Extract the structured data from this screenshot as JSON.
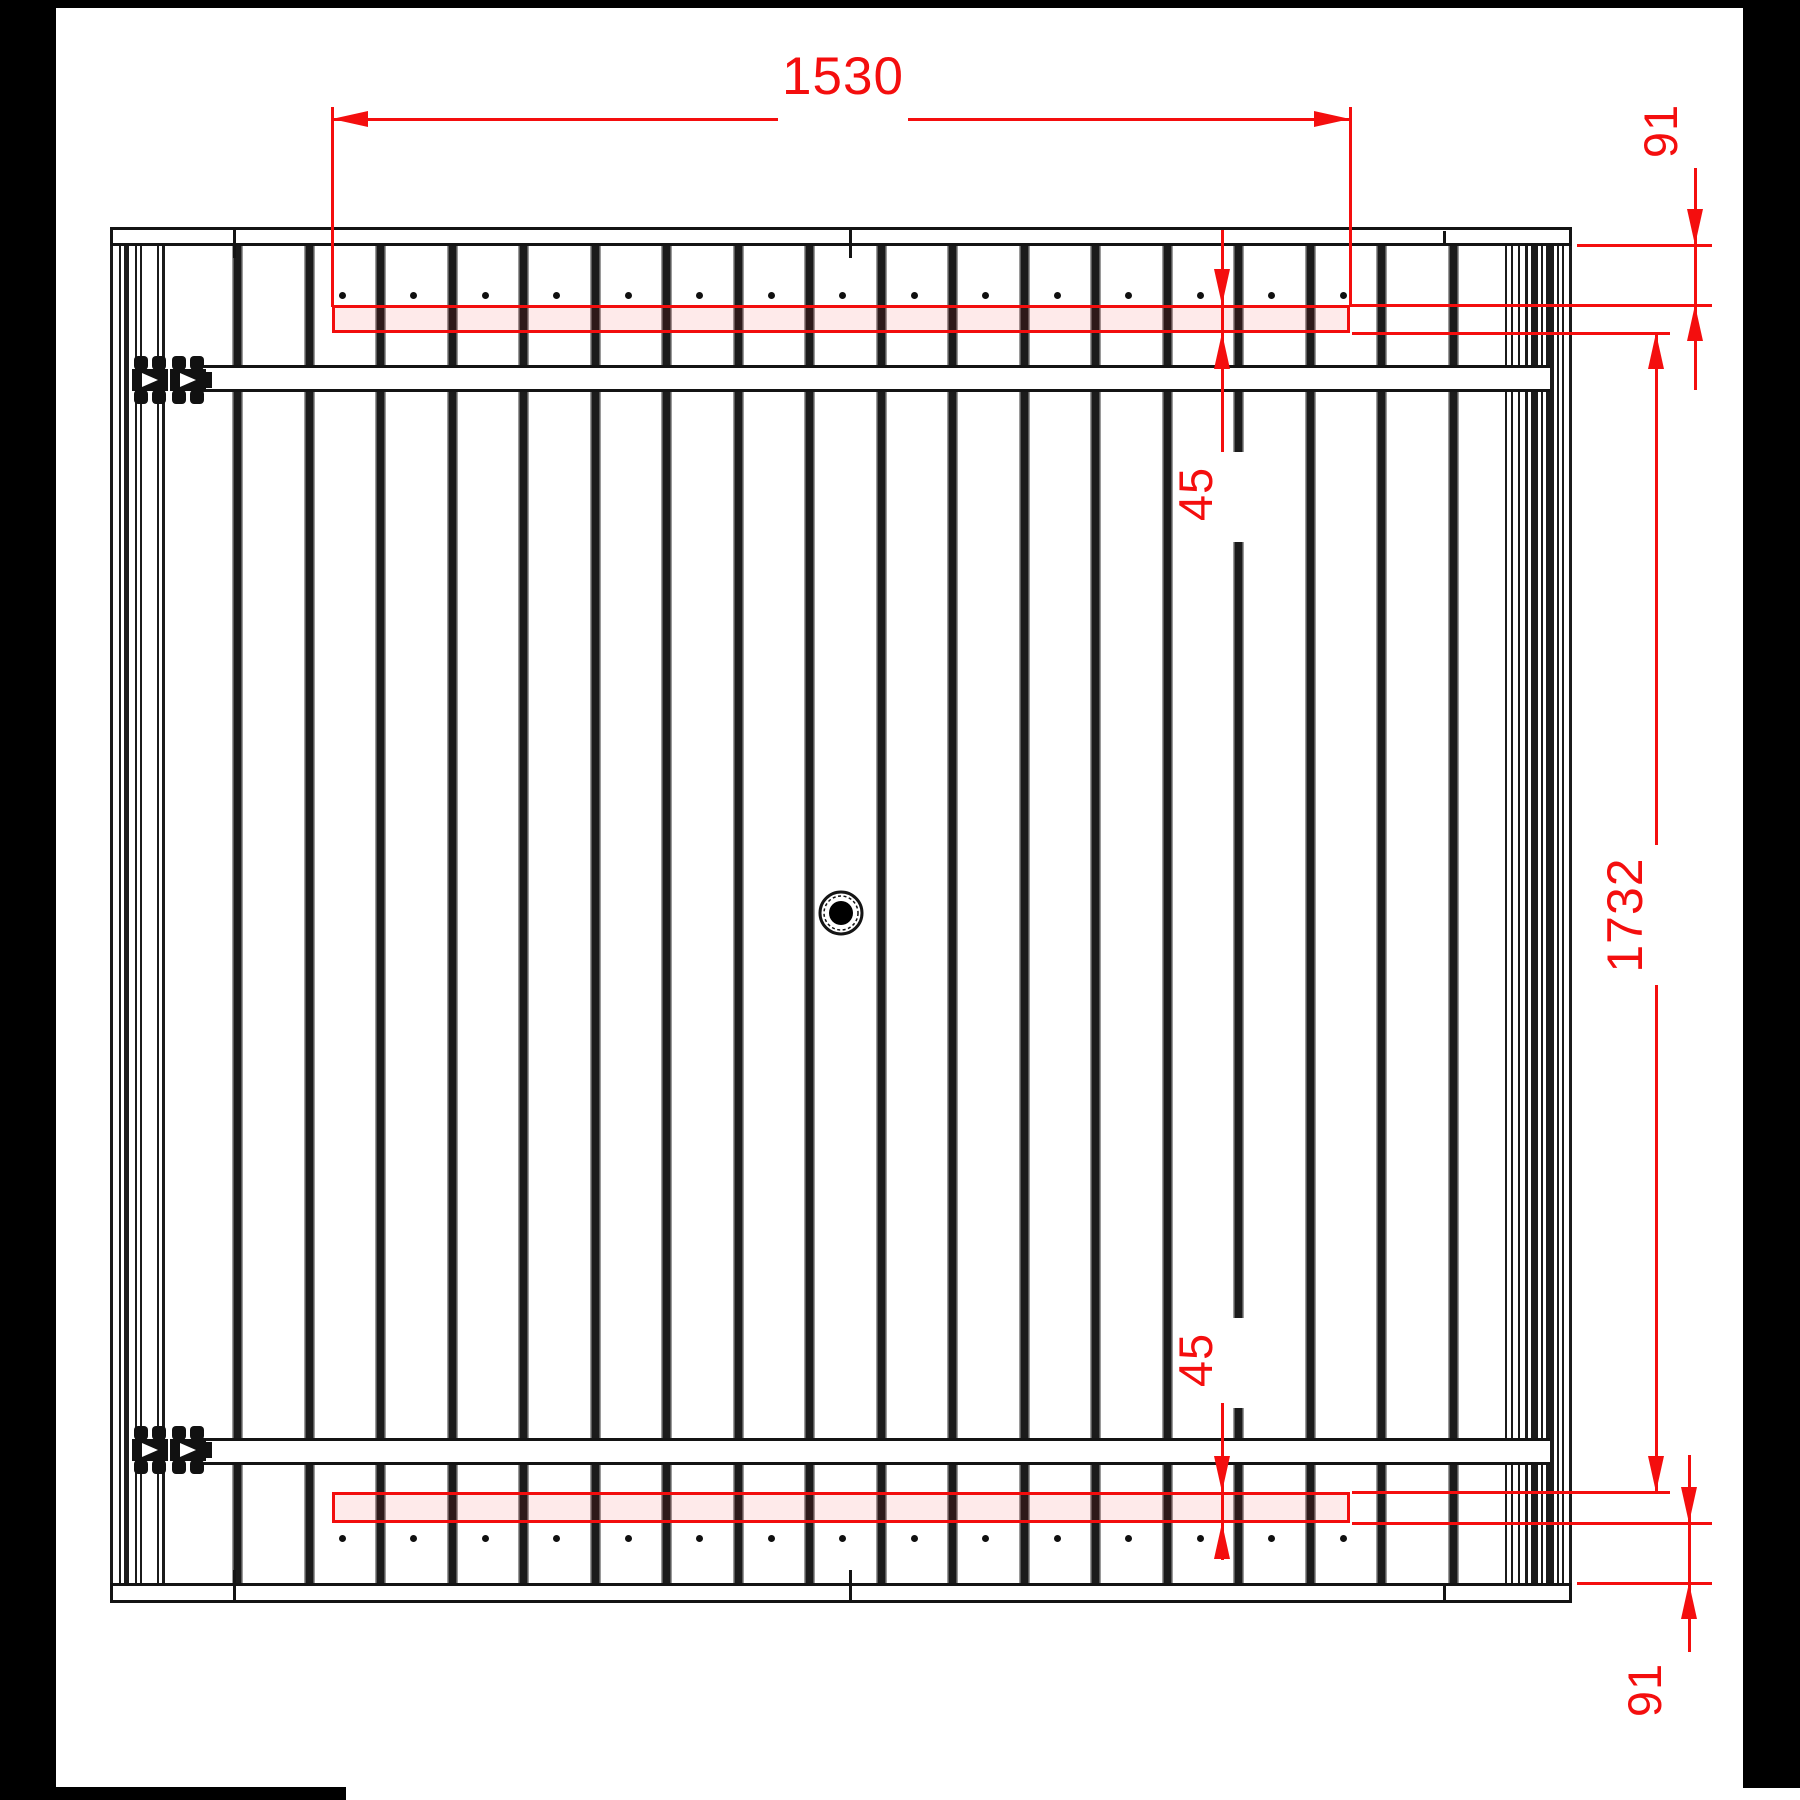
{
  "drawing": {
    "kind": "gate-panel-elevation",
    "dimensions": {
      "batten_length_top": "1530",
      "offset_top": "91",
      "batten_height_top": "45",
      "clear_span": "1732",
      "batten_height_bottom": "45",
      "offset_bottom": "91"
    },
    "panel": {
      "board_gap_count": 18,
      "screws_per_batten": 15,
      "batten_count": 2,
      "rail_count": 2,
      "hinge_count": 2,
      "cap_seam_count": 3
    },
    "colors": {
      "dimension_red": "#f40e0e",
      "batten_fill": "rgba(245,15,15,0.085)",
      "line_black": "#141414",
      "board_edge_gray": "#9a9a9a"
    }
  }
}
